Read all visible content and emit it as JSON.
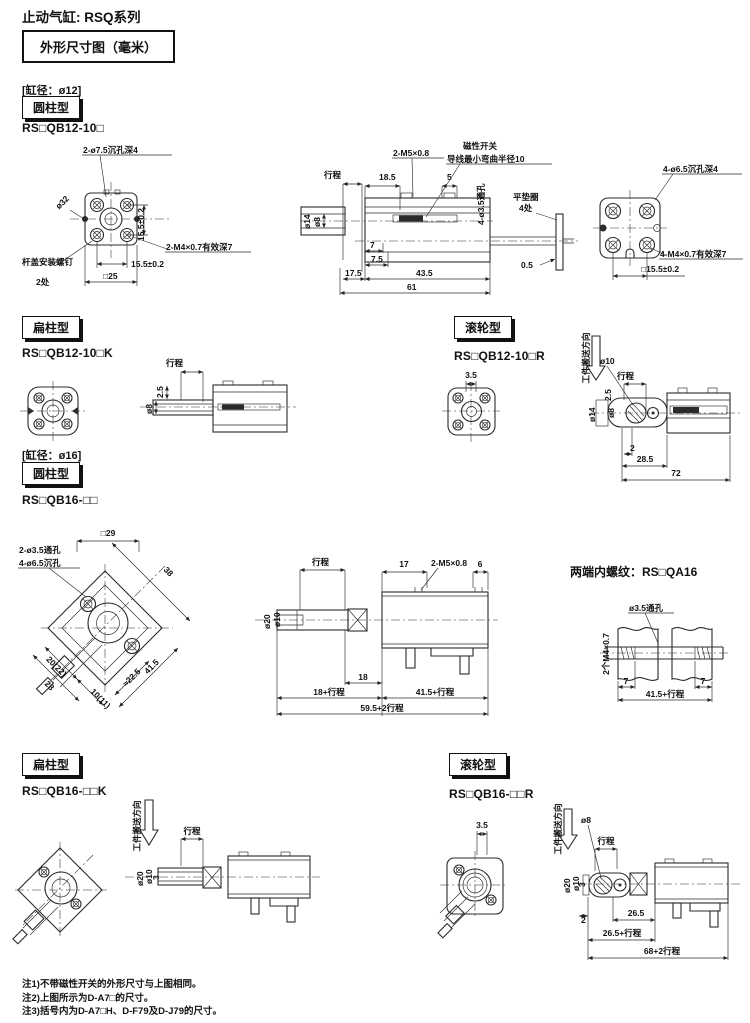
{
  "page": {
    "title": "止动气缸: RSQ系列",
    "dim_box": "外形尺寸图（毫米）",
    "bore12": "[缸径：ø12]",
    "bore16": "[缸径：ø16]",
    "thread_title": "两端内螺纹：RS□QA16",
    "notes": [
      "注1)不带磁性开关的外形尺寸与上图相同。",
      "注2)上图所示为D-A7□的尺寸。",
      "注3)括号内为D-A7□H、D-F79及D-J79的尺寸。"
    ]
  },
  "sections": {
    "b12_round": {
      "label": "圆柱型",
      "model": "RS□QB12-10□"
    },
    "b12_flat": {
      "label": "扁柱型",
      "model": "RS□QB12-10□K"
    },
    "b12_roller": {
      "label": "滚轮型",
      "model": "RS□QB12-10□R"
    },
    "b16_round": {
      "label": "圆柱型",
      "model": "RS□QB16-□□"
    },
    "b16_flat": {
      "label": "扁柱型",
      "model": "RS□QB16-□□K"
    },
    "b16_roller": {
      "label": "滚轮型",
      "model": "RS□QB16-□□R"
    }
  },
  "d12_front": {
    "cbore": "2-ø7.5沉孔深4",
    "dia32": "ø32",
    "pitch_v": "15.5±0.2",
    "thread": "2-M4×0.7有效深7",
    "pitch_h": "15.5±0.2",
    "rod_screw": "杆盖安装螺钉",
    "rod_screw2": "2处",
    "sq25": "□25"
  },
  "d12_side": {
    "stroke": "行程",
    "thread": "2-M5×0.8",
    "switch": "磁性开关",
    "switch2": "导线最小弯曲半径10",
    "d18_5": "18.5",
    "d5": "5",
    "dia14": "ø14",
    "dia8": "ø8",
    "holes": "4-ø3.5通孔",
    "washer": "平垫圈",
    "washer2": "4处",
    "d0_5": "0.5",
    "d7": "7",
    "d7_5": "7.5",
    "d17_5": "17.5",
    "d43_5": "43.5",
    "d61": "61"
  },
  "d12_end": {
    "cbore": "4-ø6.5沉孔深4",
    "thread": "4-M4×0.7有效深7",
    "sq": "□15.5±0.2"
  },
  "d12_flat": {
    "stroke": "行程",
    "d2_5": "2.5",
    "dia8": "ø8"
  },
  "d12_roller": {
    "d3_5": "3.5",
    "dir": "工件搬送方向",
    "dia10": "ø10",
    "stroke": "行程",
    "d2_5": "2.5",
    "dia14": "ø14",
    "dia8": "ø8",
    "d2": "2",
    "d28_5": "28.5",
    "d72": "72"
  },
  "d16_front": {
    "holes": "2-ø3.5通孔",
    "cbore": "4-ø6.5沉孔",
    "sq29": "□29",
    "d38": "38",
    "d20": "20(22)",
    "d28": "28",
    "d10": "10(11)",
    "d22_5": "≈22.5",
    "d41_5": "41.5"
  },
  "d16_side": {
    "stroke": "行程",
    "d17": "17",
    "thread": "2-M5×0.8",
    "d6": "6",
    "dia20": "ø20",
    "dia10": "ø10",
    "d18": "18",
    "d18s": "18+行程",
    "d41_5s": "41.5+行程",
    "d59_5s": "59.5+2行程"
  },
  "d16_thread": {
    "hole": "ø3.5通孔",
    "thread": "2个M4×0.7",
    "d7l": "7",
    "d7r": "7",
    "d41_5s": "41.5+行程"
  },
  "d16_flat": {
    "dir": "工件搬送方向",
    "stroke": "行程",
    "dia20": "ø20",
    "dia10": "ø10",
    "d3": "3"
  },
  "d16_roller": {
    "d3_5": "3.5",
    "dir": "工件搬送方向",
    "dia8": "ø8",
    "stroke": "行程",
    "dia20": "ø20",
    "dia10": "ø10",
    "d3": "3",
    "d2": "2",
    "d26_5": "26.5",
    "d26_5s": "26.5+行程",
    "d68s": "68+2行程"
  }
}
